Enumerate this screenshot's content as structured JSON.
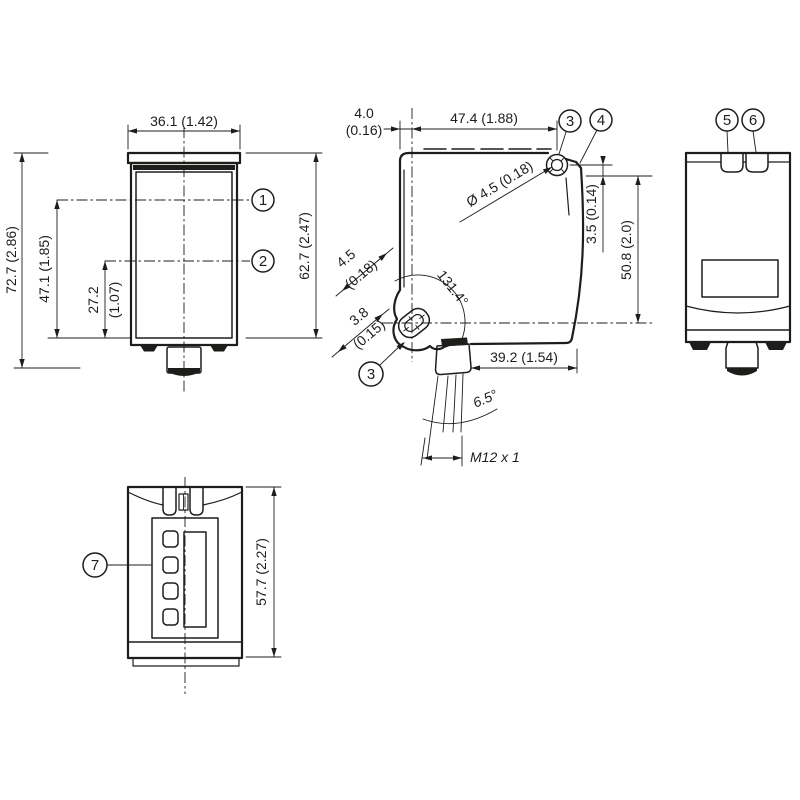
{
  "colors": {
    "ink": "#1d1d1b",
    "background": "#ffffff"
  },
  "views": {
    "front": {
      "dims": {
        "width": "36.1 (1.42)",
        "total_height": "72.7 (2.86)",
        "axis1_height": "47.1 (1.85)",
        "axis2_height_mm": "27.2",
        "axis2_height_in": "(1.07)",
        "body_height": "62.7 (2.47)"
      },
      "callouts": [
        "1",
        "2"
      ]
    },
    "side": {
      "dims": {
        "face_offset_mm": "4.0",
        "face_offset_in": "(0.16)",
        "top_width": "47.4 (1.88)",
        "hole_diameter": "Ø 4.5 (0.18)",
        "hole_top_offset": "3.5 (0.14)",
        "hole_spacing": "50.8 (2.0)",
        "slot_width_mm": "4.5",
        "slot_width_in": "(0.18)",
        "slot_length_mm": "3.8",
        "slot_length_in": "(0.15)",
        "swivel_angle": "131.4°",
        "bottom_width": "39.2 (1.54)",
        "connector_tilt": "6.5°",
        "thread": "M12 x 1"
      },
      "callouts": [
        "3",
        "4",
        "3"
      ]
    },
    "rear": {
      "callouts": [
        "5",
        "6"
      ]
    },
    "bottom": {
      "dims": {
        "height": "57.7 (2.27)"
      },
      "callouts": [
        "7"
      ]
    }
  }
}
